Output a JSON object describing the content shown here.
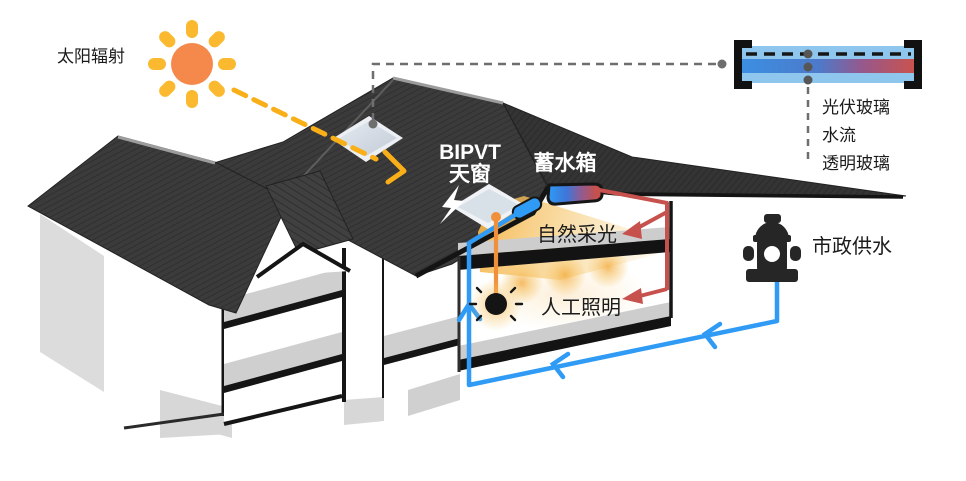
{
  "labels": {
    "solar_radiation": "太阳辐射",
    "bipvt_line1": "BIPVT",
    "bipvt_line2": "天窗",
    "water_tank": "蓄水箱",
    "natural_daylighting": "自然采光",
    "artificial_lighting": "人工照明",
    "municipal_water": "市政供水"
  },
  "detail_panel": {
    "pv_glass": "光伏玻璃",
    "water_flow": "水流",
    "transparent_glass": "透明玻璃"
  },
  "icons": {
    "sun": "sun with 8 rays",
    "lightning": "electricity bolt on roof",
    "light_bulb": "hanging bulb with shine ticks",
    "fire_hydrant": "municipal water hydrant"
  },
  "colors": {
    "sun_core": "#F5894C",
    "sun_rays": "#FBB92F",
    "cold_water_pipe": "#2F9BF4",
    "hot_water_pipe": "#C6514D",
    "electric_wire": "#F0903C",
    "roof_dark": "#3A3A3A",
    "daylight_glow": "#F6BE55",
    "glass_light_blue": "#8EC6EE"
  }
}
